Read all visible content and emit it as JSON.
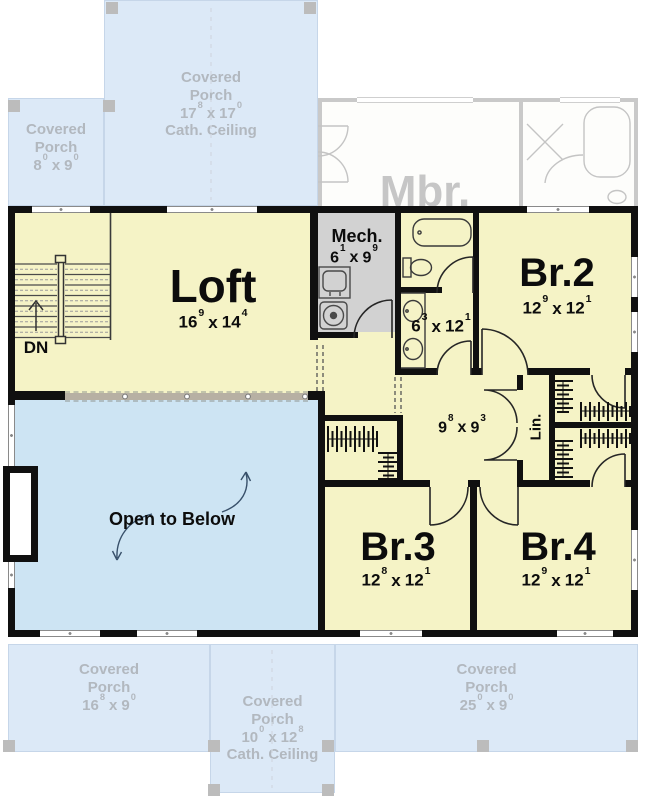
{
  "sep": "x",
  "colors": {
    "wall": "#101010",
    "room_yellow": "#f5f3c6",
    "open_below_blue": "#cde4f3",
    "porch_blue": "#dce9f7",
    "mech_gray": "#d2d2d2",
    "ghost_text": "#b2b8bf",
    "ghost_wall": "#c9c9c9"
  },
  "rooms": {
    "loft": {
      "label": "Loft",
      "dim": {
        "w": "16",
        "wi": "9",
        "h": "14",
        "hi": "4"
      }
    },
    "mech": {
      "label": "Mech.",
      "dim": {
        "w": "6",
        "wi": "1",
        "h": "9",
        "hi": "9"
      }
    },
    "bath": {
      "dim": {
        "w": "6",
        "wi": "3",
        "h": "12",
        "hi": "1"
      }
    },
    "br2": {
      "label": "Br.2",
      "dim": {
        "w": "12",
        "wi": "9",
        "h": "12",
        "hi": "1"
      }
    },
    "hall": {
      "dim": {
        "w": "9",
        "wi": "8",
        "h": "9",
        "hi": "3"
      }
    },
    "lin": {
      "label": "Lin."
    },
    "open_below": {
      "label": "Open to Below"
    },
    "br3": {
      "label": "Br.3",
      "dim": {
        "w": "12",
        "wi": "8",
        "h": "12",
        "hi": "1"
      }
    },
    "br4": {
      "label": "Br.4",
      "dim": {
        "w": "12",
        "wi": "9",
        "h": "12",
        "hi": "1"
      }
    },
    "stairs": {
      "label": "DN"
    }
  },
  "ghost": {
    "mbr": {
      "label": "Mbr."
    },
    "porches": {
      "top_left": {
        "label": "Covered Porch",
        "dim": {
          "w": "8",
          "wi": "0",
          "h": "9",
          "hi": "0"
        }
      },
      "top_center": {
        "label": "Covered Porch",
        "dim": {
          "w": "17",
          "wi": "8",
          "h": "17",
          "hi": "0"
        },
        "note": "Cath. Ceiling"
      },
      "bottom_left": {
        "label": "Covered Porch",
        "dim": {
          "w": "16",
          "wi": "8",
          "h": "9",
          "hi": "0"
        }
      },
      "bottom_center": {
        "label": "Covered Porch",
        "dim": {
          "w": "10",
          "wi": "0",
          "h": "12",
          "hi": "8"
        },
        "note": "Cath. Ceiling"
      },
      "bottom_right": {
        "label": "Covered Porch",
        "dim": {
          "w": "25",
          "wi": "0",
          "h": "9",
          "hi": "0"
        }
      }
    }
  }
}
